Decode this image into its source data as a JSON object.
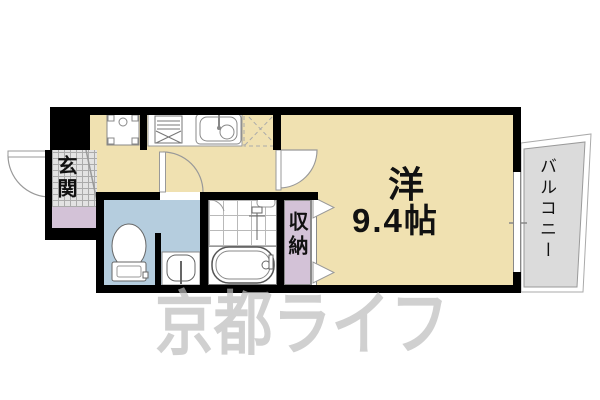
{
  "colors": {
    "wall": "#000000",
    "room_floor": "#F0E1B1",
    "wet_area": "#B5CDDE",
    "hall_floor": "#D3C2D7",
    "tile": "#E3E3E3",
    "grid_line": "#ABABAB",
    "balcony": "#DBDBDB",
    "watermark": "#BDBDBD"
  },
  "labels": {
    "entrance": "玄関",
    "room_type": "洋",
    "room_size": "9.4帖",
    "storage": "収納",
    "balcony": "バルコニー"
  },
  "watermark": {
    "text": "京都ライフ"
  }
}
